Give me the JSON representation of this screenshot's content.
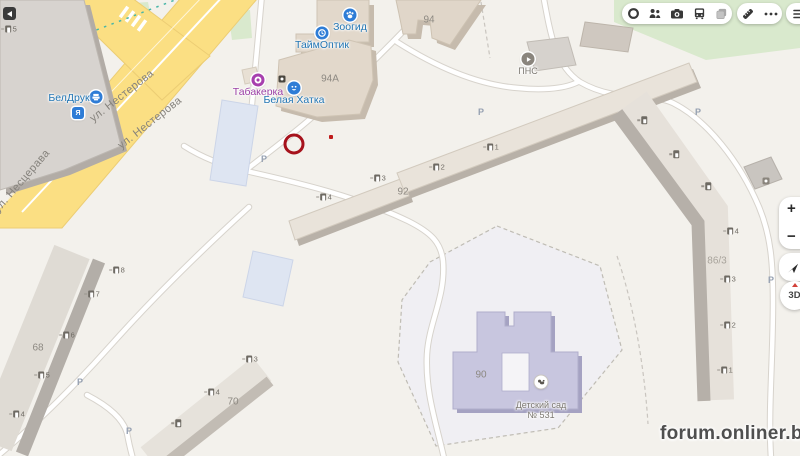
{
  "map": {
    "streets": {
      "nesterova": "ул. Нестерова",
      "nescerava": "ул. Несцерава"
    },
    "buildings": {
      "b94": "94",
      "b94a": "94А",
      "b92": "92",
      "b90": "90",
      "b68": "68",
      "b70": "70",
      "b86": "86/3"
    },
    "pois": {
      "zoogid": {
        "label": "Зоогид",
        "icon": "paw-icon",
        "color": "#2e7cd6"
      },
      "taimoptik": {
        "label": "ТаймОптик",
        "icon": "clock-icon",
        "color": "#2e7cd6"
      },
      "tabakerka": {
        "label": "Табакерка",
        "icon": "donut-icon",
        "color": "#a73fae"
      },
      "belaya_hatka": {
        "label": "Белая Хатка",
        "icon": "smiley-icon",
        "color": "#2e7cd6"
      },
      "beldruk": {
        "label": "БелДрук",
        "icon": "printer-icon",
        "color": "#2e7cd6"
      },
      "pns": {
        "label": "ПНС",
        "icon": "utility-icon",
        "color": "#8a857d"
      },
      "detsad": {
        "label": "Детский сад № 531",
        "icon": "kindergarten-icon",
        "color": "#ffffff"
      }
    },
    "parking_label": "Р",
    "entrances": {
      "e92": [
        "1",
        "2",
        "3",
        "4"
      ],
      "e68": [
        "8",
        "7",
        "6",
        "5",
        "4"
      ],
      "e70": [
        "3",
        "4",
        ""
      ],
      "e86u": [
        "",
        "",
        ""
      ],
      "e86": [
        "4",
        "3",
        "2",
        "1"
      ],
      "etl": [
        "5"
      ]
    },
    "annotation": {
      "shape": "red-circle-highlight"
    },
    "colors": {
      "road_yellow": "#fbdf83",
      "poi_blue": "#2276b4",
      "poi_purple": "#9b3fa5",
      "kindergarten_fill": "#c8c6df",
      "annotation_red": "#a6121c"
    }
  },
  "toolbar": {
    "icons": [
      "traffic-ring",
      "mirrors-people",
      "panoramas-camera",
      "transport-bus",
      "layers",
      "ruler",
      "more-dots",
      "menu-burger"
    ]
  },
  "controls": {
    "zoom_in": "+",
    "zoom_out": "−",
    "compass": "3D"
  },
  "watermark": "forum.onliner.by"
}
